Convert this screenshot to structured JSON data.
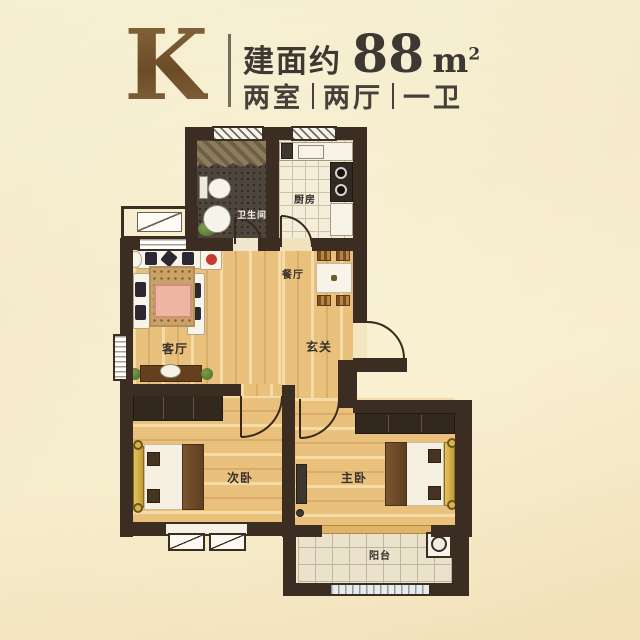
{
  "header": {
    "plan_letter": "K",
    "area_prefix": "建面约",
    "area_value": "88",
    "area_unit_base": "m",
    "area_unit_exp": "2",
    "specs": [
      "两室",
      "两厅",
      "一卫"
    ]
  },
  "rooms": {
    "bathroom": "卫生间",
    "kitchen": "厨房",
    "dining": "餐厅",
    "foyer": "玄关",
    "living": "客厅",
    "bedroom_second": "次卧",
    "bedroom_master": "主卧",
    "balcony": "阳台"
  },
  "colors": {
    "plan_letter": "#77552e",
    "wall": "#3b2d22",
    "wood_floor": "#e9c17d",
    "background": "#f4ead0",
    "header_text": "#3d3831"
  }
}
